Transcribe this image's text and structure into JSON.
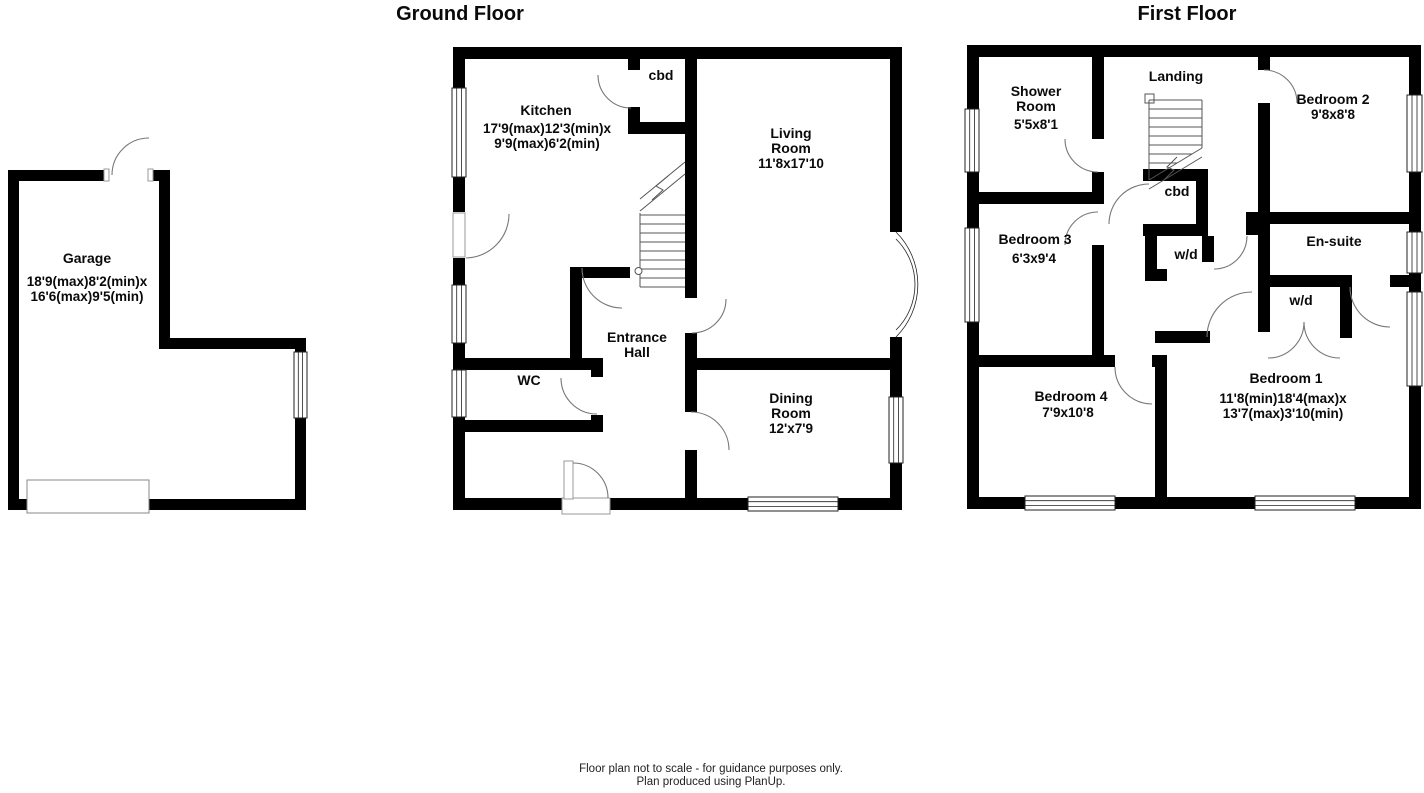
{
  "page": {
    "background": "#ffffff",
    "wall_color": "#000000",
    "footer": {
      "line1": "Floor plan not to scale - for guidance purposes only.",
      "line2": "Plan produced using PlanUp."
    }
  },
  "garage": {
    "name": "Garage",
    "dims_line1": "18'9(max)8'2(min)x",
    "dims_line2": "16'6(max)9'5(min)"
  },
  "ground_floor": {
    "title": "Ground Floor",
    "kitchen_name": "Kitchen",
    "kitchen_dims1": "17'9(max)12'3(min)x",
    "kitchen_dims2": "9'9(max)6'2(min)",
    "cbd": "cbd",
    "living_name1": "Living",
    "living_name2": "Room",
    "living_dims": "11'8x17'10",
    "entrance_name1": "Entrance",
    "entrance_name2": "Hall",
    "wc": "WC",
    "dining_name1": "Dining",
    "dining_name2": "Room",
    "dining_dims": "12'x7'9"
  },
  "first_floor": {
    "title": "First Floor",
    "landing": "Landing",
    "shower_name1": "Shower",
    "shower_name2": "Room",
    "shower_dims": "5'5x8'1",
    "bedroom2_name": "Bedroom 2",
    "bedroom2_dims": "9'8x8'8",
    "bedroom3_name": "Bedroom 3",
    "bedroom3_dims": "6'3x9'4",
    "cbd": "cbd",
    "wd_landing": "w/d",
    "ensuite": "En-suite",
    "wd_bedroom1": "w/d",
    "bedroom1_name": "Bedroom 1",
    "bedroom1_dims1": "11'8(min)18'4(max)x",
    "bedroom1_dims2": "13'7(max)3'10(min)",
    "bedroom4_name": "Bedroom 4",
    "bedroom4_dims": "7'9x10'8"
  }
}
